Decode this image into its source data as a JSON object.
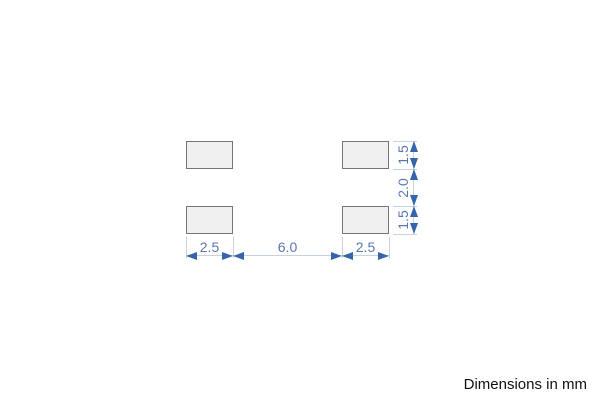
{
  "drawing": {
    "kind": "component-footprint-dimension-drawing",
    "pads": [
      {
        "position": "top-left"
      },
      {
        "position": "top-right"
      },
      {
        "position": "bottom-left"
      },
      {
        "position": "bottom-right"
      }
    ],
    "horizontal_dims": [
      {
        "label": "2.5"
      },
      {
        "label": "6.0"
      },
      {
        "label": "2.5"
      }
    ],
    "vertical_dims": [
      {
        "label": "1.5"
      },
      {
        "label": "2.0"
      },
      {
        "label": "1.5"
      }
    ],
    "units_note": "Dimensions in mm",
    "colors": {
      "dimension_blue": "#3566ac",
      "dimension_text": "#5b77ad",
      "dimension_line": "#c7d1e2",
      "pad_fill": "#f0f0f0",
      "pad_border": "#757575",
      "note_color": "#111111"
    }
  }
}
